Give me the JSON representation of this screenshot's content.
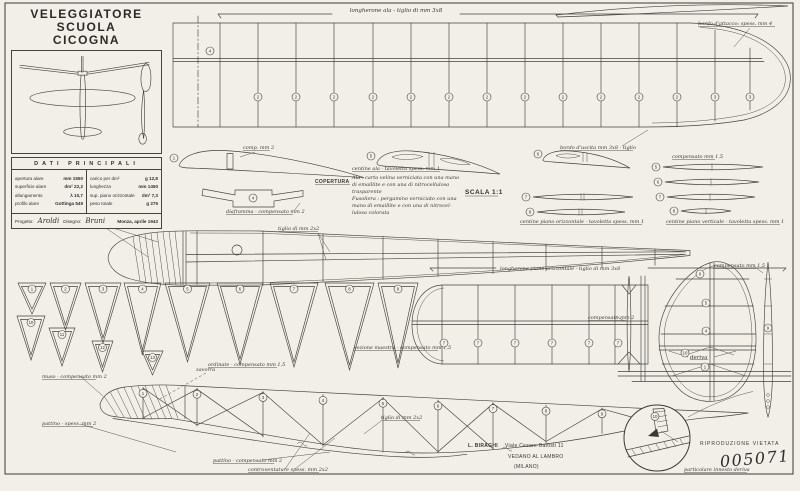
{
  "title_block": {
    "title_line1": "VELEGGIATORE SCUOLA",
    "title_line2": "CICOGNA",
    "dati_title": "DATI PRINCIPALI",
    "left_rows": [
      {
        "label": "apertura alare",
        "value": "mm 1550"
      },
      {
        "label": "superficie alare",
        "value": "dm² 22,2"
      },
      {
        "label": "allungamento",
        "value": "λ 10,7"
      },
      {
        "label": "profilo alare",
        "value": "Gottinga 549"
      }
    ],
    "right_rows": [
      {
        "label": "carico per dm²",
        "value": "g 12,8"
      },
      {
        "label": "lunghezza",
        "value": "mm 1450"
      },
      {
        "label": "sup. piano orizzontale",
        "value": "dm² 7,3"
      },
      {
        "label": "peso totale",
        "value": "g 275"
      }
    ],
    "progetto_label": "Progetto:",
    "progetto_name": "Aroldi",
    "disegno_label": "Disegno:",
    "disegno_name": "Bruni",
    "place_date": "Monza, aprile 1943"
  },
  "wing": {
    "spar_note": "longherone ala - tiglio di mm 3x8",
    "leading_edge_note": "bordo d'attacco: spess. mm 4",
    "trailing_edge_note": "bordo d'uscita mm 3x8 - tiglio",
    "center_rib_number": "4",
    "rib_numbers": [
      "2",
      "2",
      "2",
      "2",
      "2",
      "2",
      "2",
      "2",
      "2",
      "2",
      "2",
      "2",
      "3",
      "3"
    ]
  },
  "sections": {
    "root_rib_number": "1",
    "root_rib_note": "comp. mm 2",
    "builtup1_number": "5",
    "builtup2_number": "6",
    "diaframma_number": "4",
    "diaframma_note": "diaframma - compensato mm 2",
    "ribs_note": "centine ala - tavoletta spess. mm 1",
    "copertura_title": "COPERTURA",
    "copertura_lines": [
      "Ala : carta velina verniciata con una mano",
      "di emaillite e con una di nitrocellulosa",
      "trasparente",
      "Fusoliera : pergamino verniciato con una",
      "mano di emaillite e con una di nitrocel-",
      "lulosa colorata"
    ],
    "scale_note": "SCALA 1:1",
    "stab_lens_note": "centine piano orizzontale - tavoletta spess. mm 1",
    "stab_lens_numbers": [
      "7",
      "8"
    ],
    "fin_lens_material": "compensato mm 1,5",
    "fin_lens_note": "centine piano verticale - tavoletta spess. mm 1",
    "fin_lens_numbers": [
      "5",
      "6",
      "7",
      "8"
    ]
  },
  "fuselage_top": {
    "nose_note": "musetto - compensato mm 2",
    "longeron_note": "tiglio di mm 2x2"
  },
  "tail": {
    "stab_spar_note": "longherone piano orizzontale - tiglio di mm 3x8",
    "stab_center_note": "compensato mm 2",
    "stab_rib_numbers": [
      "7",
      "7",
      "7",
      "7",
      "7",
      "7"
    ],
    "deriva_label": "deriva",
    "fin_rib_numbers": [
      "6",
      "5",
      "4",
      "10",
      "1"
    ],
    "fin_side_number": "9",
    "fin_side_note": "compensato mm 1,5"
  },
  "formers": {
    "note": "ordinate - compensato mm 1,5",
    "master_note": "sezione maestra - compensato mm 1,5",
    "large_numbers": [
      "1",
      "2",
      "3",
      "4",
      "5",
      "6",
      "7",
      "8",
      "9"
    ],
    "small_numbers": [
      "10",
      "11",
      "12",
      "13"
    ]
  },
  "fuselage_side": {
    "station_numbers": [
      "1",
      "2",
      "3",
      "4",
      "5",
      "6",
      "7",
      "8",
      "9",
      "10"
    ],
    "nose_note": "muso - compensato mm 2",
    "ballast_note": "zavorra",
    "skid_note": "pattino - spess. mm 2",
    "skid_note2": "pattino - compensato mm 2",
    "bracing_note": "controventature spess. mm 2x2",
    "longeron_note": "tiglio di mm 2x2"
  },
  "footer": {
    "publisher_name": "L. BIRAGHI",
    "publisher_address": "Viale Cesare Battisti 11",
    "publisher_city": "VEDANO AL LAMBRO",
    "publisher_prov": "(MILANO)",
    "rights": "RIPRODUZIONE VIETATA",
    "plan_number": "005071",
    "detail_caption": "particolare innesto deriva"
  }
}
